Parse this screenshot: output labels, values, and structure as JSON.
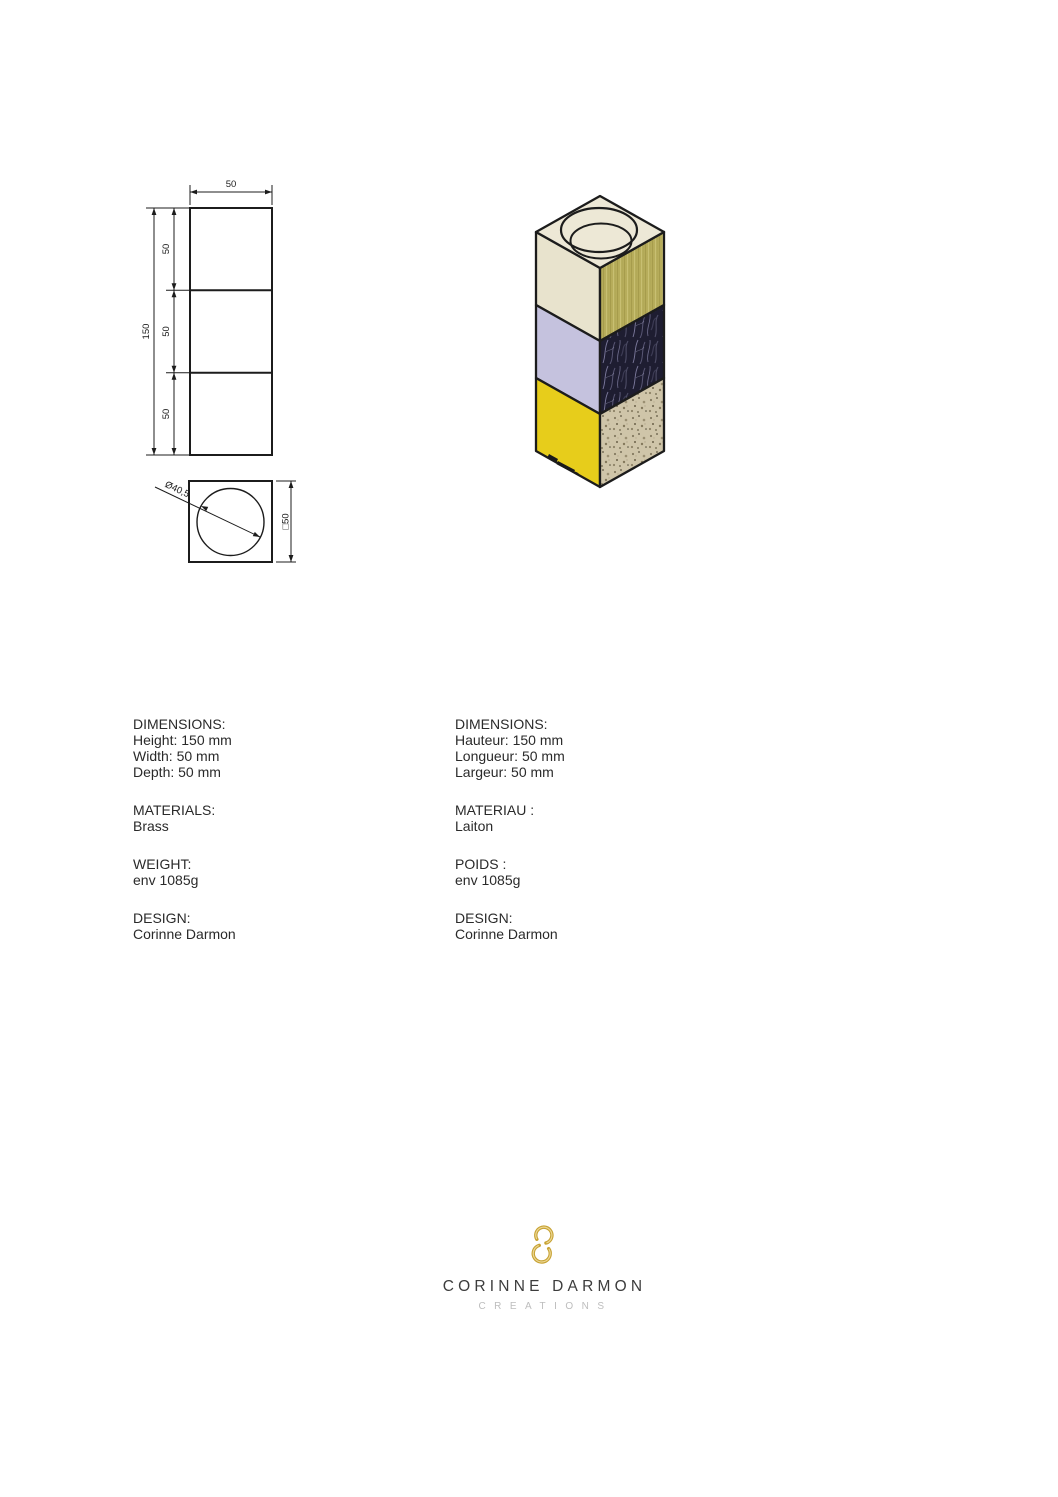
{
  "page": {
    "background": "#ffffff"
  },
  "technical_drawing": {
    "line_color": "#1c1c1c",
    "front_view": {
      "width_label": "50",
      "total_height_label": "150",
      "section_height_labels": [
        "50",
        "50",
        "50"
      ]
    },
    "bottom_view": {
      "diameter_label": "Ø40,5",
      "square_side_label": "□50"
    }
  },
  "product_render": {
    "colors": {
      "top_face": "#ede8d6",
      "cream_face": "#e8e3cd",
      "brushed_brass_face": "#b7ad5b",
      "lavender_face": "#c5c2de",
      "dark_patina_face": "#1e1d31",
      "yellow_face": "#e7cd1b",
      "granite_face": "#cfc5a9",
      "outline": "#1c1c1c"
    }
  },
  "specs": {
    "en": [
      {
        "title": "DIMENSIONS:",
        "lines": [
          "Height: 150 mm",
          "Width: 50 mm",
          "Depth: 50 mm"
        ]
      },
      {
        "title": "MATERIALS:",
        "lines": [
          "Brass"
        ]
      },
      {
        "title": "WEIGHT:",
        "lines": [
          "env 1085g"
        ]
      },
      {
        "title": "DESIGN:",
        "lines": [
          "Corinne Darmon"
        ]
      }
    ],
    "fr": [
      {
        "title": "DIMENSIONS:",
        "lines": [
          "Hauteur: 150 mm",
          "Longueur: 50 mm",
          "Largeur: 50 mm"
        ]
      },
      {
        "title": "MATERIAU :",
        "lines": [
          "Laiton"
        ]
      },
      {
        "title": "POIDS :",
        "lines": [
          "env 1085g"
        ]
      },
      {
        "title": "DESIGN:",
        "lines": [
          "Corinne Darmon"
        ]
      }
    ]
  },
  "brand": {
    "name": "CORINNE DARMON",
    "subtitle": "CREATIONS",
    "gold_color": "#c7a233",
    "name_color": "#3c3c3c",
    "subtitle_color": "#bdbdbd"
  }
}
